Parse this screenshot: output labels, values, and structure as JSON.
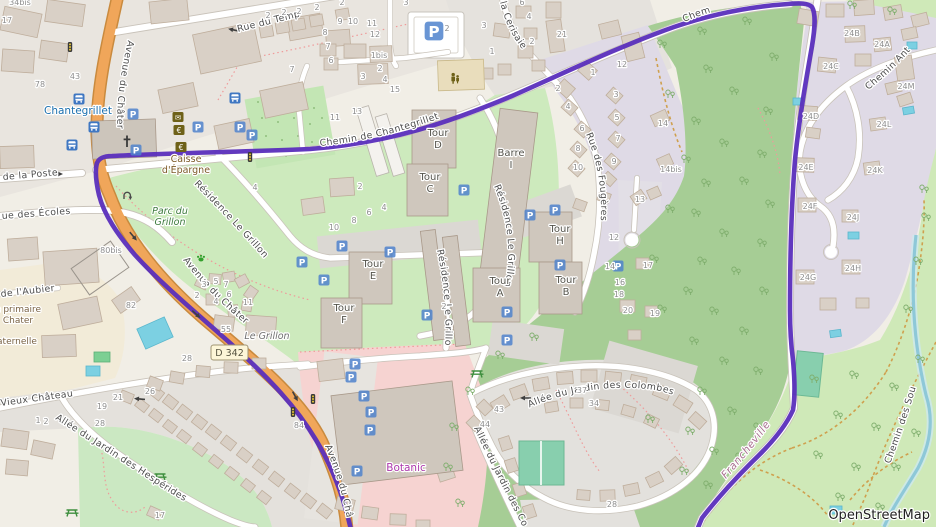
{
  "map": {
    "attribution": {
      "text": "OpenStreetMap"
    },
    "road_badge": {
      "text": "D 342"
    },
    "colors": {
      "route": "#5a2ebc",
      "forest": "#a6cd95",
      "grass": "#cfe9b8",
      "water": "#8ec8d8",
      "retail": "#f6d3d1",
      "road_primary": "#f0a65a",
      "parking_blue": "#4f83cc",
      "amenity_olive": "#6e6118",
      "shop_label": "#ab37ab",
      "transit_label": "#1a6fae"
    },
    "street_labels": {
      "temple": "Rue du Temp",
      "poste": "de la Poste",
      "ecoles": "ue des Écoles",
      "aubier": "de l'Aubier",
      "vieux": "Vieux Château",
      "avenue_top": "Avenue du Châter",
      "avenue_mid": "Avenue du Châter",
      "avenue_bottom": "Avenue du Châ",
      "chantegrillet": "Chemin de Chantegrillet",
      "chem": "Chem",
      "chemin_ant": "Chemin Ant",
      "cerisaie": "la Cerisaie",
      "fougeres": "Rue des Fougères",
      "residence_a": "Résidence Le Grillon",
      "residence_b": "Résidence Le Grillon",
      "residence_c": "Résidence Le Grillo",
      "colombes_1": "Allée du Jardin des Colombes",
      "colombes_2": "Allée du Jardin des Co",
      "hesperides": "Allée du Jardin des Hespérides",
      "sources": "Chemin des Sou",
      "francheville": "Francheville"
    },
    "place_labels": [
      {
        "cls": "transit",
        "lines": [
          "Chantegrillet"
        ],
        "x": 78,
        "y": 114
      },
      {
        "cls": "park",
        "lines": [
          "Parc du",
          "Grillon"
        ],
        "x": 170,
        "y": 214
      },
      {
        "cls": "amenity",
        "lines": [
          "Caisse",
          "d'Épargne"
        ],
        "x": 186,
        "y": 162
      },
      {
        "cls": "shop",
        "lines": [
          "Botanic"
        ],
        "x": 406,
        "y": 471
      },
      {
        "cls": "locality",
        "lines": [
          "Le Grillon"
        ],
        "x": 267,
        "y": 339
      },
      {
        "cls": "school",
        "lines": [
          "e primaire",
          "Chater"
        ],
        "x": 18,
        "y": 312
      },
      {
        "cls": "school",
        "lines": [
          "aternelle"
        ],
        "x": 17,
        "y": 344
      }
    ],
    "building_labels": [
      {
        "lines": [
          "Tour",
          "D"
        ],
        "x": 438,
        "y": 136
      },
      {
        "lines": [
          "Tour",
          "C"
        ],
        "x": 430,
        "y": 180
      },
      {
        "lines": [
          "Tour",
          "E"
        ],
        "x": 373,
        "y": 267
      },
      {
        "lines": [
          "Tour",
          "F"
        ],
        "x": 344,
        "y": 311
      },
      {
        "lines": [
          "Tour",
          "A"
        ],
        "x": 500,
        "y": 284
      },
      {
        "lines": [
          "Tour",
          "B"
        ],
        "x": 566,
        "y": 283
      },
      {
        "lines": [
          "Tour",
          "H"
        ],
        "x": 560,
        "y": 232
      },
      {
        "lines": [
          "Barre",
          "I"
        ],
        "x": 511,
        "y": 156
      }
    ],
    "house_numbers": [
      [
        "34bis",
        20,
        5
      ],
      [
        "17",
        7,
        23
      ],
      [
        "78",
        40,
        87
      ],
      [
        "43",
        75,
        79
      ],
      [
        "7",
        292,
        72
      ],
      [
        "2",
        268,
        18
      ],
      [
        "2",
        284,
        15
      ],
      [
        "2",
        299,
        14
      ],
      [
        "2",
        317,
        10
      ],
      [
        "2",
        342,
        5
      ],
      [
        "3",
        406,
        5
      ],
      [
        "9",
        340,
        24
      ],
      [
        "10",
        353,
        24
      ],
      [
        "11",
        372,
        26
      ],
      [
        "12",
        375,
        37
      ],
      [
        "8",
        325,
        35
      ],
      [
        "7",
        328,
        49
      ],
      [
        "6",
        331,
        63
      ],
      [
        "1bis",
        379,
        58
      ],
      [
        "2",
        380,
        71
      ],
      [
        "3",
        363,
        79
      ],
      [
        "4",
        385,
        82
      ],
      [
        "15",
        395,
        92
      ],
      [
        "13",
        357,
        114
      ],
      [
        "11",
        335,
        120
      ],
      [
        "6",
        522,
        5
      ],
      [
        "4",
        529,
        19
      ],
      [
        "3",
        484,
        28
      ],
      [
        "2",
        532,
        44
      ],
      [
        "1",
        492,
        54
      ],
      [
        "21",
        562,
        37
      ],
      [
        "2",
        447,
        31
      ],
      [
        "4",
        255,
        190
      ],
      [
        "1",
        593,
        75
      ],
      [
        "2",
        558,
        91
      ],
      [
        "3",
        616,
        97
      ],
      [
        "4",
        568,
        109
      ],
      [
        "5",
        617,
        120
      ],
      [
        "6",
        582,
        131
      ],
      [
        "7",
        618,
        141
      ],
      [
        "8",
        578,
        151
      ],
      [
        "9",
        614,
        164
      ],
      [
        "10",
        578,
        170
      ],
      [
        "12",
        622,
        67
      ],
      [
        "14",
        663,
        126
      ],
      [
        "14bis",
        671,
        172
      ],
      [
        "13",
        640,
        202
      ],
      [
        "17",
        648,
        268
      ],
      [
        "20",
        628,
        313
      ],
      [
        "19",
        655,
        316
      ],
      [
        "24B",
        852,
        36
      ],
      [
        "24A",
        882,
        47
      ],
      [
        "24C",
        831,
        69
      ],
      [
        "24M",
        906,
        89
      ],
      [
        "24D",
        811,
        119
      ],
      [
        "24L",
        884,
        127
      ],
      [
        "24E",
        806,
        170
      ],
      [
        "24K",
        875,
        173
      ],
      [
        "24F",
        810,
        209
      ],
      [
        "24J",
        853,
        220
      ],
      [
        "24H",
        853,
        271
      ],
      [
        "24G",
        808,
        280
      ],
      [
        "2",
        360,
        189
      ],
      [
        "4",
        384,
        210
      ],
      [
        "6",
        369,
        215
      ],
      [
        "8",
        354,
        223
      ],
      [
        "10",
        334,
        230
      ],
      [
        "12",
        614,
        240
      ],
      [
        "14",
        610,
        269
      ],
      [
        "16",
        620,
        285
      ],
      [
        "18",
        619,
        297
      ],
      [
        "2",
        444,
        309
      ],
      [
        "3",
        204,
        287
      ],
      [
        "5",
        216,
        284
      ],
      [
        "7",
        226,
        287
      ],
      [
        "2",
        197,
        298
      ],
      [
        "4",
        216,
        304
      ],
      [
        "6",
        229,
        297
      ],
      [
        "11",
        248,
        305
      ],
      [
        "55",
        226,
        332
      ],
      [
        "80bis",
        111,
        253
      ],
      [
        "82",
        131,
        308
      ],
      [
        "28",
        187,
        361
      ],
      [
        "84",
        299,
        428
      ],
      [
        "43",
        499,
        412
      ],
      [
        "44",
        485,
        427
      ],
      [
        "37",
        582,
        393
      ],
      [
        "34",
        594,
        406
      ],
      [
        "28",
        612,
        507
      ],
      [
        "28",
        100,
        426
      ],
      [
        "21",
        118,
        400
      ],
      [
        "26",
        150,
        394
      ],
      [
        "19",
        102,
        409
      ],
      [
        "17",
        160,
        518
      ],
      [
        "1",
        38,
        423
      ],
      [
        "2",
        46,
        424
      ]
    ],
    "icons": {
      "parking": {
        "glyph": "P",
        "positions": [
          [
            133,
            114
          ],
          [
            136,
            150
          ],
          [
            198,
            127
          ],
          [
            240,
            127
          ],
          [
            252,
            135
          ],
          [
            464,
            190
          ],
          [
            530,
            215
          ],
          [
            555,
            210
          ],
          [
            560,
            265
          ],
          [
            342,
            246
          ],
          [
            324,
            280
          ],
          [
            390,
            252
          ],
          [
            427,
            315
          ],
          [
            507,
            312
          ],
          [
            507,
            340
          ],
          [
            618,
            266
          ],
          [
            302,
            262
          ],
          [
            355,
            364
          ],
          [
            351,
            377
          ],
          [
            364,
            396
          ],
          [
            371,
            412
          ],
          [
            370,
            430
          ],
          [
            357,
            471
          ]
        ],
        "large_position": [
          434,
          31
        ]
      },
      "bus_stop": {
        "positions": [
          [
            79,
            99
          ],
          [
            94,
            127
          ],
          [
            72,
            145
          ],
          [
            235,
            98
          ]
        ]
      },
      "traffic_signals": {
        "positions": [
          [
            70,
            47
          ],
          [
            250,
            157
          ],
          [
            313,
            399
          ],
          [
            293,
            412
          ]
        ]
      },
      "picnic_table": {
        "positions": [
          [
            160,
            476
          ],
          [
            72,
            512
          ],
          [
            477,
            373
          ]
        ]
      },
      "post_box": {
        "glyph": "✉",
        "position": [
          178,
          117
        ]
      },
      "bank": {
        "glyph": "€",
        "positions": [
          [
            179,
            130
          ],
          [
            181,
            147
          ]
        ]
      },
      "childcare": {
        "position": [
          455,
          78
        ]
      },
      "dog_park": {
        "position": [
          201,
          258
        ]
      },
      "church": {
        "position": [
          127,
          142
        ]
      },
      "u_turn": {
        "position": [
          127,
          196
        ]
      },
      "one_way_arrows": [
        [
          57,
          174,
          0
        ],
        [
          234,
          30,
          192
        ],
        [
          526,
          398,
          180
        ],
        [
          140,
          399,
          185
        ],
        [
          133,
          236,
          50
        ],
        [
          196,
          314,
          42
        ],
        [
          295,
          396,
          62
        ]
      ]
    }
  }
}
